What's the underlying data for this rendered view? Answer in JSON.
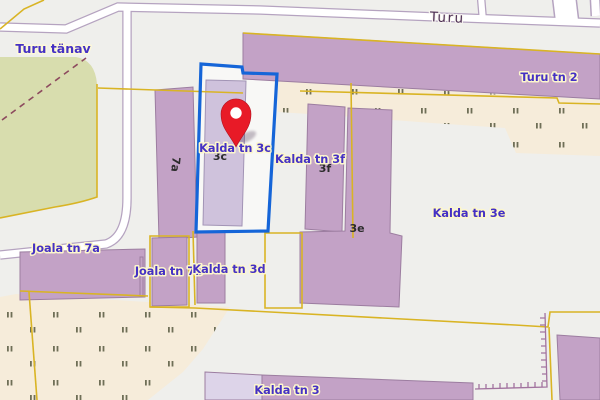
{
  "map": {
    "street_labels": {
      "turu_road": "Turu",
      "turu_tanav": "Turu tänav",
      "joala_tn_7a": "Joala tn 7a"
    },
    "address_labels": {
      "turu_tn_2": "Turu tn 2",
      "kalda_tn_3c": "Kalda tn 3c",
      "kalda_tn_3f": "Kalda tn 3f",
      "kalda_tn_3e": "Kalda tn 3e",
      "kalda_tn_3d": "Kalda tn 3d",
      "kalda_tn_3": "Kalda tn 3",
      "joala_tn_7b": "Joala tn 7b"
    },
    "building_numbers": {
      "b7a": "7a",
      "b3f": "3f",
      "b3e": "3e",
      "b3c": "3c"
    },
    "marker": {
      "name": "red-location-pin",
      "address": "Kalda tn 3c"
    },
    "colors": {
      "background": "#efefec",
      "building": "#c3a2c6",
      "building_light": "#cfc2dc",
      "building_pale": "#ddd4e9",
      "green_area": "#d8ddae",
      "scrub_area": "#f6ecda",
      "scrub_symbol": "#6f6f57",
      "road_fill": "#ffffff",
      "road_casing": "#b5a3c0",
      "boundary_yellow": "#d9b424",
      "selection_blue": "#1565d8",
      "marker_red": "#e81a27",
      "label_blue": "#4531c4",
      "street_name": "#4d2f54",
      "number_black": "#2c2c2c",
      "path_dashes": "#8d4a5e",
      "fence_line": "#a2739f"
    }
  }
}
